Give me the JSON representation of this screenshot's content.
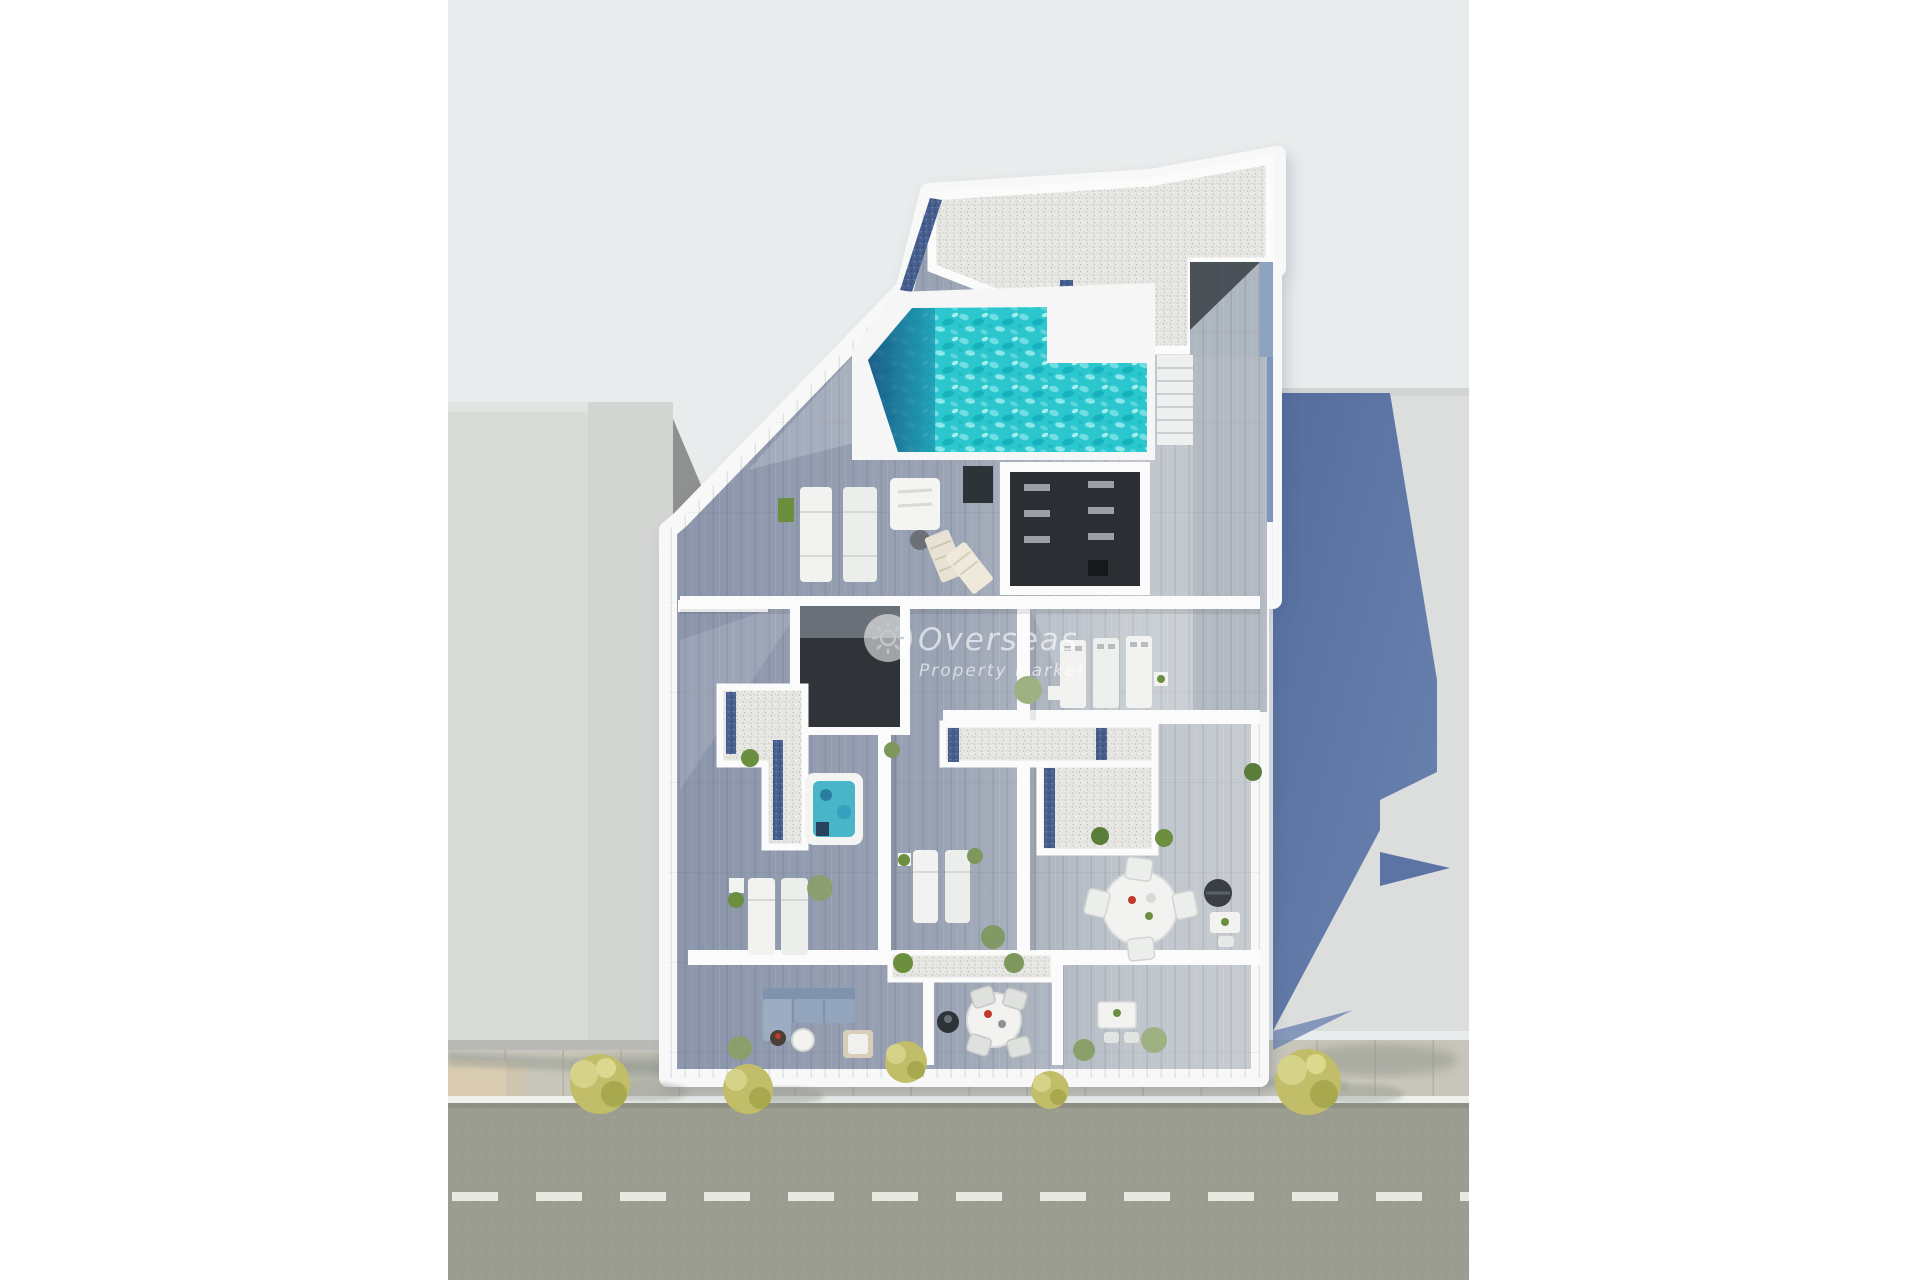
{
  "image": {
    "type": "aerial-3d-floorplan-render",
    "subject": "Top-down 3D render of a penthouse / apartment building with rooftop pool, wooden terraces, street and sidewalk"
  },
  "watermark": {
    "line1": "Overseas",
    "line2": "Property Market",
    "logo": "sun-logo-icon"
  },
  "colors": {
    "bg-canvas": "#ffffff",
    "bg-photo": "#e9ecec",
    "neighbor-gray": "#d9dbd8",
    "neighbor-gray-dark": "#cfd1ce",
    "building-white": "#f6f7f6",
    "wall-white": "#fafbfa",
    "wood-dark": "#8b95ab",
    "wood-light": "#c6cbd1",
    "roof-gravel": "#e4e4e1",
    "gravel-navy": "#47608f",
    "pool-turquoise": "#2cc7ce",
    "pool-deep": "#174a7c",
    "shadow-blue": "#5b74a3",
    "road-gray": "#9b9d90",
    "sidewalk-gray": "#c8c5ba",
    "curb-white": "#eef0ec",
    "tile-beige": "#d9ccb1",
    "tree-olive": "#c2bd69",
    "plant-green": "#6b8f3f",
    "furniture-white": "#f2f3f1",
    "dark-opening": "#2b2f34"
  },
  "scene": {
    "objects": [
      "rooftop-pool",
      "pool-deck",
      "pool-stairs",
      "roof-gravel-terrace",
      "jacuzzi",
      "sun-loungers",
      "deck-chairs",
      "outdoor-dining-table",
      "barbecue",
      "outdoor-sofa",
      "stairwell-opening",
      "ac-units",
      "planters",
      "street-trees",
      "road",
      "sidewalk",
      "dashed-lane-line",
      "neighbor-building-left",
      "neighbor-building-right",
      "cast-shadow"
    ]
  }
}
